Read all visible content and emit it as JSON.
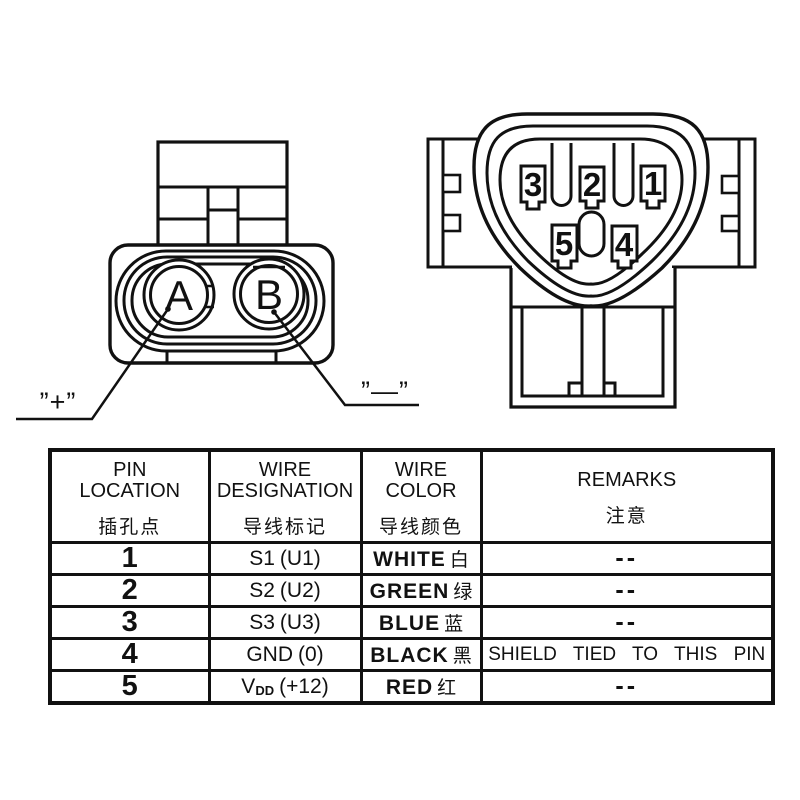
{
  "left_connector": {
    "cavity_labels": [
      "A",
      "B"
    ],
    "positive_label": "”+”",
    "negative_label": "”—”"
  },
  "right_connector": {
    "pin_labels": [
      "1",
      "2",
      "3",
      "4",
      "5"
    ]
  },
  "table": {
    "headers": [
      {
        "en1": "PIN",
        "en2": "LOCATION",
        "zh": "插孔点"
      },
      {
        "en1": "WIRE",
        "en2": "DESIGNATION",
        "zh": "导线标记"
      },
      {
        "en1": "WIRE",
        "en2": "COLOR",
        "zh": "导线颜色"
      },
      {
        "en1": "REMARKS",
        "en2": "",
        "zh": "注意"
      }
    ],
    "rows": [
      {
        "pin": "1",
        "designation_main": "S1",
        "designation_sub": "",
        "designation_rest": "(U1)",
        "color_en": "WHITE",
        "color_zh": "白",
        "remark": "--"
      },
      {
        "pin": "2",
        "designation_main": "S2",
        "designation_sub": "",
        "designation_rest": "(U2)",
        "color_en": "GREEN",
        "color_zh": "绿",
        "remark": "--"
      },
      {
        "pin": "3",
        "designation_main": "S3",
        "designation_sub": "",
        "designation_rest": "(U3)",
        "color_en": "BLUE",
        "color_zh": "蓝",
        "remark": "--"
      },
      {
        "pin": "4",
        "designation_main": "GND",
        "designation_sub": "",
        "designation_rest": "(0)",
        "color_en": "BLACK",
        "color_zh": "黑",
        "remark": "SHIELD TIED TO THIS PIN"
      },
      {
        "pin": "5",
        "designation_main": "V",
        "designation_sub": "DD",
        "designation_rest": "(+12)",
        "color_en": "RED",
        "color_zh": "红",
        "remark": "--"
      }
    ]
  },
  "colors": {
    "line": "#111111",
    "background": "#ffffff"
  }
}
